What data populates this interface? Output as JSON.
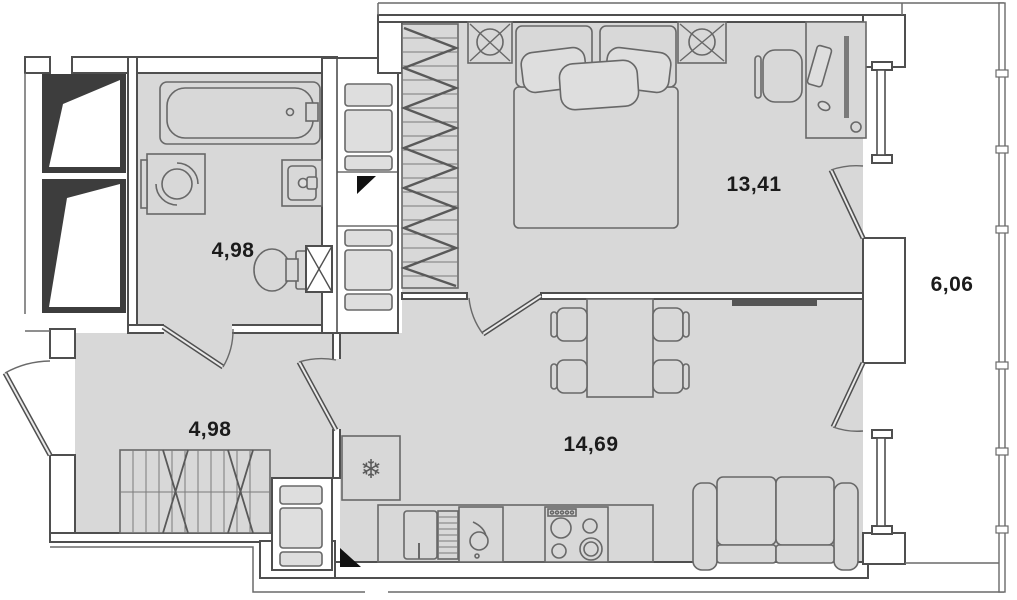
{
  "plan": {
    "type": "apartment-floor-plan",
    "rooms": [
      {
        "id": "bathroom",
        "area_label": "4,98"
      },
      {
        "id": "hallway",
        "area_label": "4,98"
      },
      {
        "id": "bedroom",
        "area_label": "13,41"
      },
      {
        "id": "kitchen-living",
        "area_label": "14,69"
      },
      {
        "id": "balcony",
        "area_label": "6,06"
      }
    ],
    "icons": {
      "snowflake": "❄"
    },
    "colors": {
      "floor": "#d8d8d8",
      "wall_line": "#4f4f4f",
      "shaft_fill": "#3d3d3d",
      "label": "#1b1b1b",
      "background": "#ffffff"
    },
    "furniture": [
      "bathtub",
      "washing-machine",
      "bathroom-sink",
      "toilet",
      "vent-grille",
      "wardrobe",
      "bed",
      "nightstand-left",
      "nightstand-right",
      "desk",
      "desk-chair",
      "dining-table",
      "dining-chairs",
      "tv",
      "sofa",
      "fridge",
      "kitchen-counter",
      "kitchen-cabinet",
      "dishwasher",
      "kitchen-sink",
      "stove",
      "hall-closet",
      "utility-column-a",
      "utility-column-b",
      "shaft-blocks",
      "balcony-glazing"
    ]
  }
}
